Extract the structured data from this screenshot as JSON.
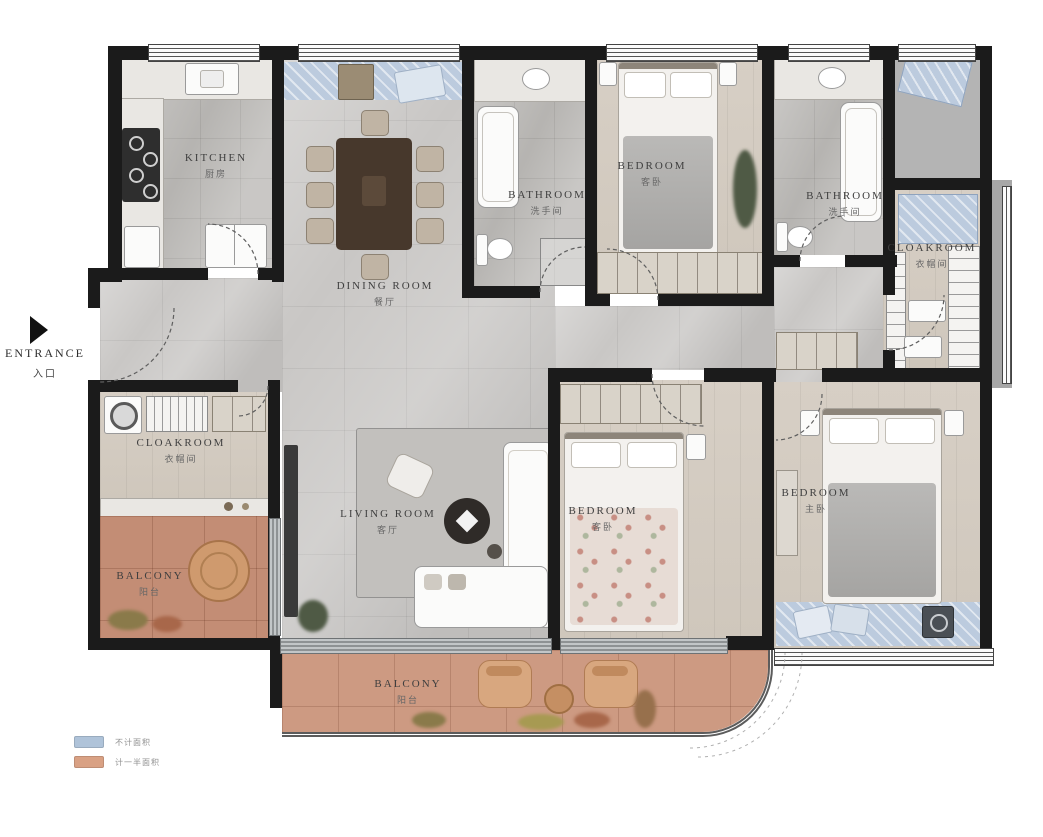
{
  "entrance": {
    "label_en": "ENTRANCE",
    "label_zh": "入口"
  },
  "rooms": {
    "kitchen": {
      "en": "KITCHEN",
      "zh": "厨房"
    },
    "dining_room": {
      "en": "DINING ROOM",
      "zh": "餐厅"
    },
    "bathroom_left": {
      "en": "BATHROOM",
      "zh": "洗手间"
    },
    "bathroom_right": {
      "en": "BATHROOM",
      "zh": "洗手间"
    },
    "bedroom_top": {
      "en": "BEDROOM",
      "zh": "客卧"
    },
    "bedroom_middle": {
      "en": "BEDROOM",
      "zh": "客卧"
    },
    "bedroom_master": {
      "en": "BEDROOM",
      "zh": "主卧"
    },
    "cloakroom_left": {
      "en": "CLOAKROOM",
      "zh": "衣帽间"
    },
    "cloakroom_right": {
      "en": "CLOAKROOM",
      "zh": "衣帽间"
    },
    "living_room": {
      "en": "LIVING ROOM",
      "zh": "客厅"
    },
    "balcony_left": {
      "en": "BALCONY",
      "zh": "阳台"
    },
    "balcony_bottom": {
      "en": "BALCONY",
      "zh": "阳台"
    }
  },
  "legend": {
    "items": [
      {
        "label": "不计面积",
        "color": "#afc3d9"
      },
      {
        "label": "计一半面积",
        "color": "#d9a184"
      }
    ]
  },
  "colors": {
    "wall": "#1b1b1b",
    "no_area_zone": "#bccbde",
    "half_area_zone": "#cd9a82"
  }
}
